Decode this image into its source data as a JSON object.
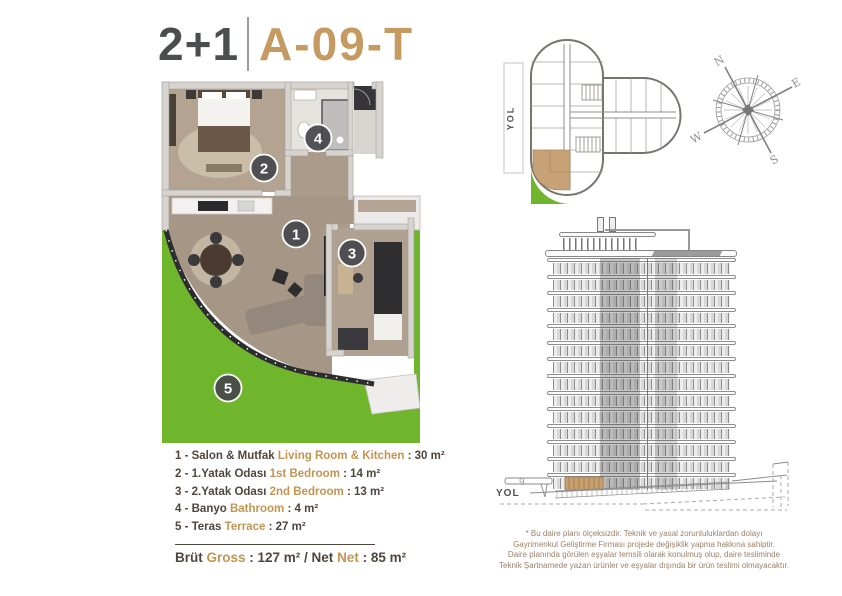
{
  "title": {
    "rooms": "2+1",
    "unit": "A-09-T"
  },
  "colors": {
    "accent_gold": "#c49a60",
    "dark_text": "#4c4d4f",
    "legend_dark": "#4f463d",
    "legend_gold": "#c39552",
    "terrace_green": "#70b62d",
    "unit_highlight_tan": "#c8a277",
    "disclaimer_brown": "#9d8168"
  },
  "floor_plan": {
    "badges": [
      "1",
      "2",
      "3",
      "4",
      "5"
    ]
  },
  "key_plan": {
    "road_label": "YOL"
  },
  "compass": {
    "n": "N",
    "e": "E",
    "s": "S",
    "w": "W"
  },
  "elevation": {
    "road_label": "YOL",
    "floor_label": "9",
    "floors": 14
  },
  "legend": {
    "items": [
      {
        "tr": "1 - Salon & Mutfak",
        "en": "Living Room & Kitchen",
        "area": ": 30 m²"
      },
      {
        "tr": "2 - 1.Yatak Odası",
        "en": "1st Bedroom",
        "area": ": 14 m²"
      },
      {
        "tr": "3 - 2.Yatak Odası",
        "en": "2nd Bedroom",
        "area": ": 13 m²"
      },
      {
        "tr": "4 - Banyo",
        "en": "Bathroom",
        "area": ": 4 m²"
      },
      {
        "tr": "5 - Teras",
        "en": "Terrace",
        "area": ": 27 m²"
      }
    ],
    "total": {
      "p1": "Brüt ",
      "p2": "Gross",
      "p3": " : 127 m² / Net ",
      "p4": "Net",
      "p5": " : 85 m²"
    }
  },
  "disclaimer": {
    "lines": [
      "* Bu daire planı ölçeksizdir. Teknik ve yasal zorunluluklardan dolayı",
      "Gayrimenkul Geliştirme Firması projede değişiklik yapma hakkına sahiptir.",
      "Daire planında görülen eşyalar temsili olarak konulmuş olup, daire tesliminde",
      "Teknik Şartnamede yazan ürünler ve eşyalar dışında bir ürün teslimi olmayacaktır."
    ]
  }
}
